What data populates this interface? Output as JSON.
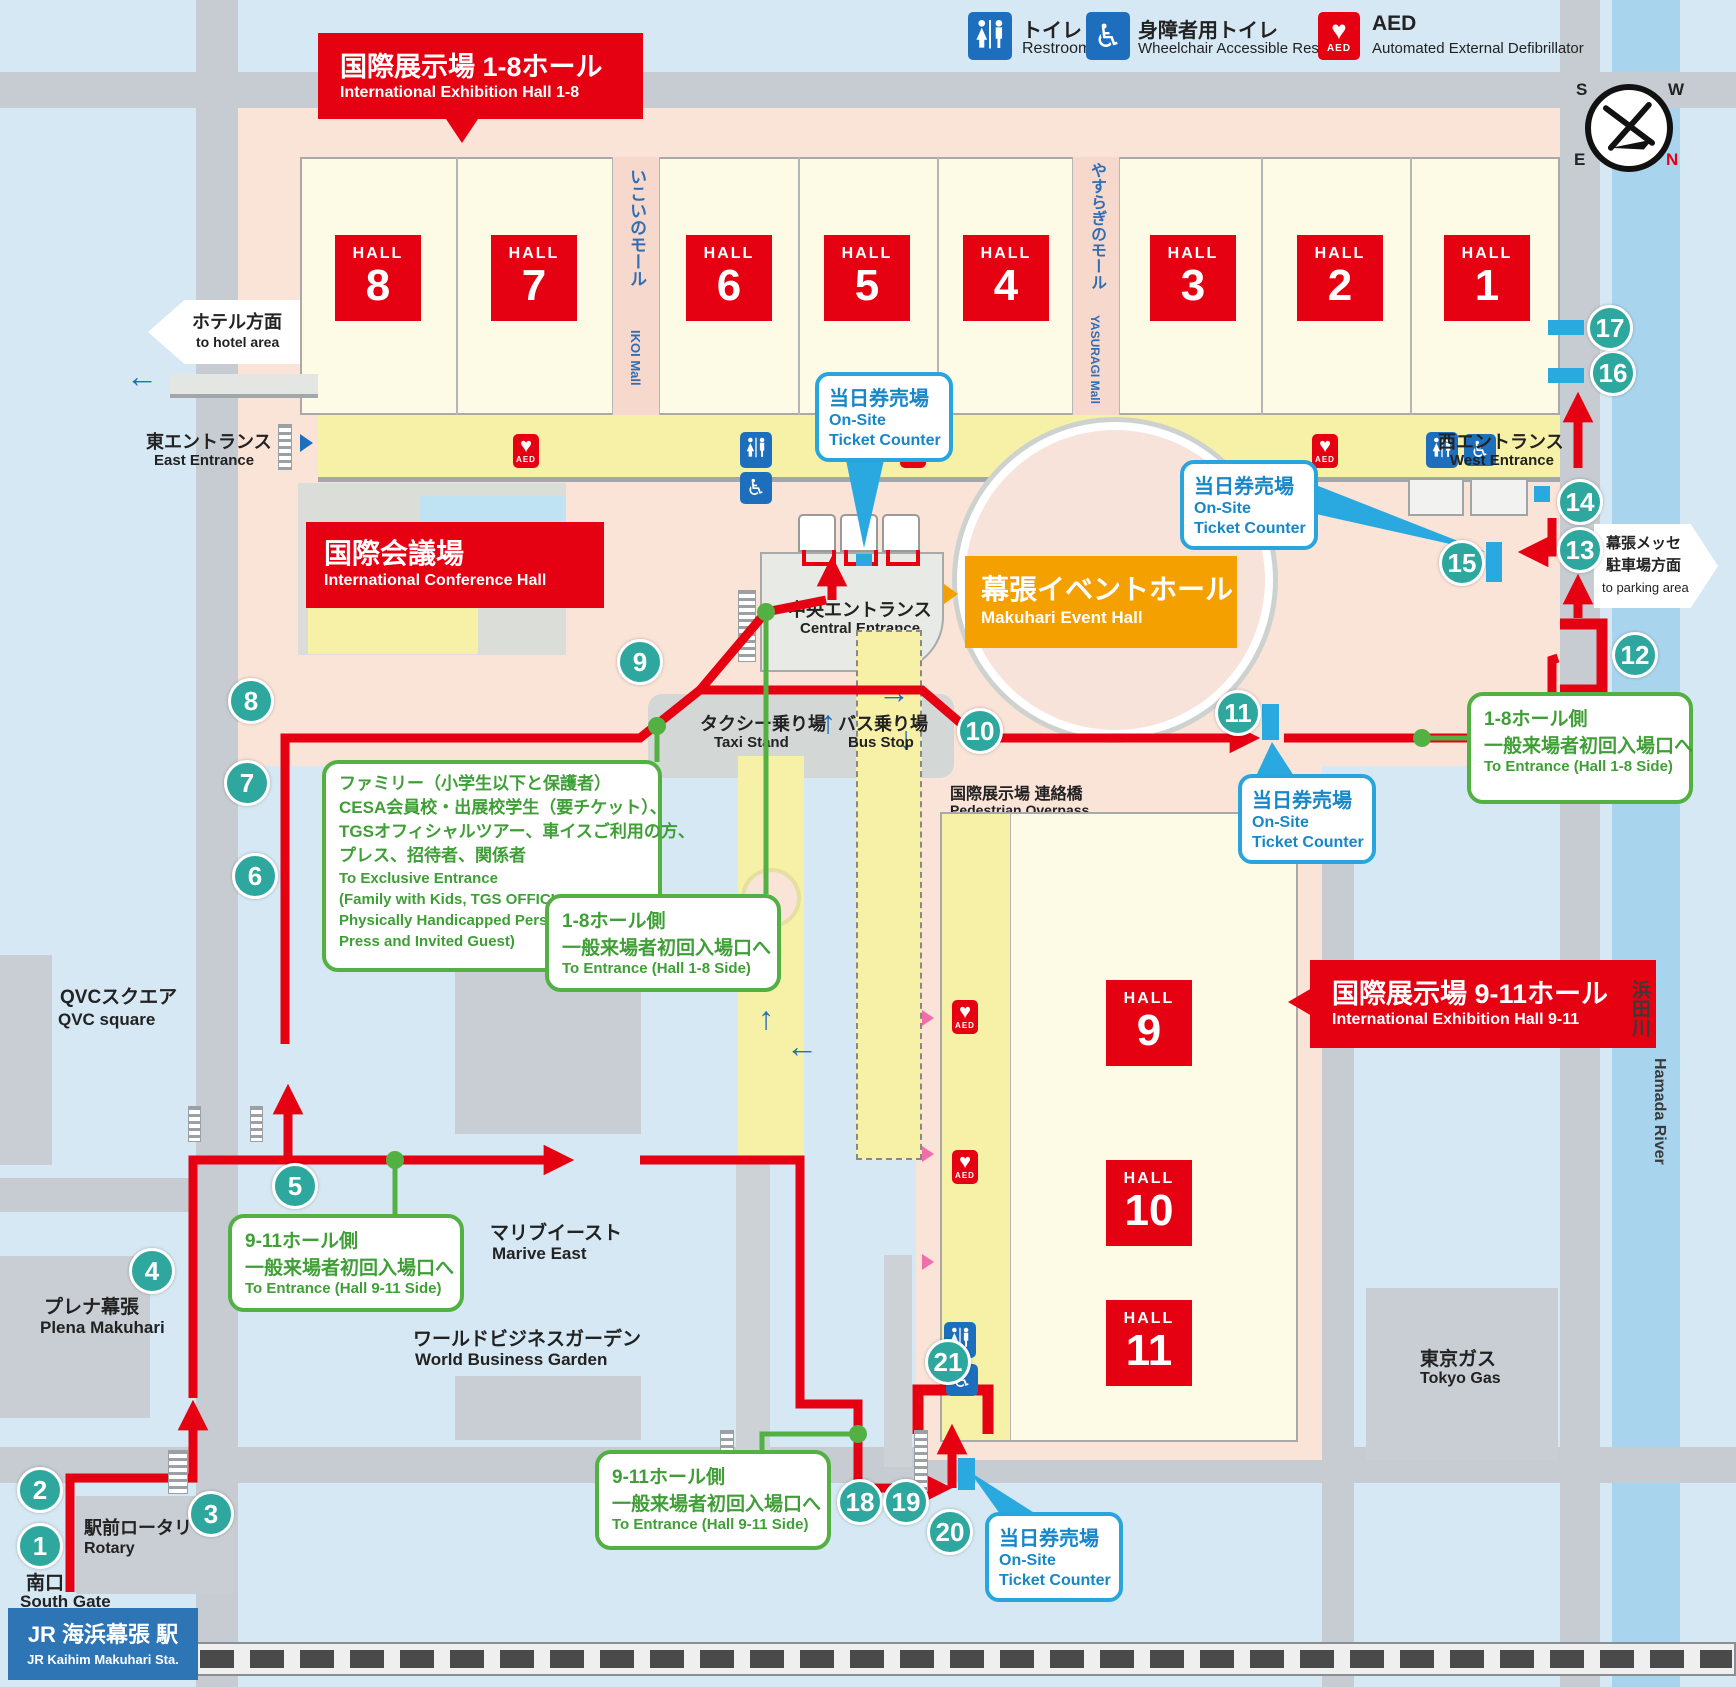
{
  "legend": {
    "restroom_jp": "トイレ",
    "restroom_en": "Restroom",
    "wheelchair_jp": "身障者用トイレ",
    "wheelchair_en": "Wheelchair Accessible Restroom",
    "aed_title": "AED",
    "aed_en": "Automated External Defibrillator",
    "aed_label": "AED"
  },
  "icons": {
    "up": "↑",
    "down": "↓",
    "left": "←",
    "right": "→",
    "heart": "♥",
    "wheelchair": "♿"
  },
  "banners": {
    "hall18_jp": "国際展示場 1-8ホール",
    "hall18_en": "International Exhibition Hall 1-8",
    "hall911_jp": "国際展示場 9-11ホール",
    "hall911_en": "International Exhibition Hall 9-11",
    "conference_jp": "国際会議場",
    "conference_en": "International Conference Hall",
    "event_jp": "幕張イベントホール",
    "event_en": "Makuhari Event Hall"
  },
  "halls": {
    "word": "HALL",
    "top": [
      "8",
      "7",
      "6",
      "5",
      "4",
      "3",
      "2",
      "1"
    ],
    "side": [
      "9",
      "10",
      "11"
    ]
  },
  "malls": {
    "ikoi_jp": "いこいのモール",
    "ikoi_en": "IKOI Mall",
    "yasuragi_jp": "やすらぎのモール",
    "yasuragi_en": "YASURAGI Mall"
  },
  "entrances": {
    "east_jp": "東エントランス",
    "east_en": "East Entrance",
    "west_jp": "西エントランス",
    "west_en": "West Entrance",
    "central_jp": "中央エントランス",
    "central_en": "Central Entrance",
    "hotel_jp": "ホテル方面",
    "hotel_en": "to hotel area",
    "parking_jp1": "幕張メッセ",
    "parking_jp2": "駐車場方面",
    "parking_en": "to parking area"
  },
  "ticket": {
    "jp": "当日券売場",
    "en1": "On-Site",
    "en2": "Ticket Counter"
  },
  "green": {
    "family_jp": [
      "ファミリー（小学生以下と保護者）",
      "CESA会員校・出展校学生（要チケット）、",
      "TGSオフィシャルツアー、車イスご利用の方、",
      "プレス、招待者、関係者"
    ],
    "family_en": [
      "To Exclusive Entrance",
      "(Family with Kids, TGS OFFICIAL TUOR,",
      "Physically Handicapped Person,",
      "Press and Invited Guest)"
    ],
    "g18_jp1": "1-8ホール側",
    "g18_jp2": "一般来場者初回入場口へ",
    "g18_en": "To Entrance (Hall 1-8 Side)",
    "g911_jp1": "9-11ホール側",
    "g911_jp2": "一般来場者初回入場口へ",
    "g911_en": "To Entrance (Hall 9-11 Side)"
  },
  "places": {
    "taxi_jp": "タクシー乗り場",
    "taxi_en": "Taxi Stand",
    "bus_jp": "バス乗り場",
    "bus_en": "Bus Stop",
    "overpass_jp": "国際展示場 連絡橋",
    "overpass_en": "Pedestrian Overpass",
    "qvc_jp": "QVCスクエア",
    "qvc_en": "QVC square",
    "plena_jp": "プレナ幕張",
    "plena_en": "Plena Makuhari",
    "marive_jp": "マリブイースト",
    "marive_en": "Marive East",
    "wbg_jp": "ワールドビジネスガーデン",
    "wbg_en": "World Business Garden",
    "tokyogas_jp": "東京ガス",
    "tokyogas_en": "Tokyo Gas",
    "river_jp": "浜田川",
    "river_en": "Hamada River",
    "rotary_jp": "駅前ロータリー",
    "rotary_en": "Rotary",
    "south_jp": "南口",
    "south_en": "South Gate",
    "station_jp": "JR 海浜幕張 駅",
    "station_en": "JR Kaihim Makuhari Sta."
  },
  "compass": {
    "n": "N",
    "s": "S",
    "e": "E",
    "w": "W"
  },
  "markers": [
    "1",
    "2",
    "3",
    "4",
    "5",
    "6",
    "7",
    "8",
    "9",
    "10",
    "11",
    "12",
    "13",
    "14",
    "15",
    "16",
    "17",
    "18",
    "19",
    "20",
    "21"
  ]
}
